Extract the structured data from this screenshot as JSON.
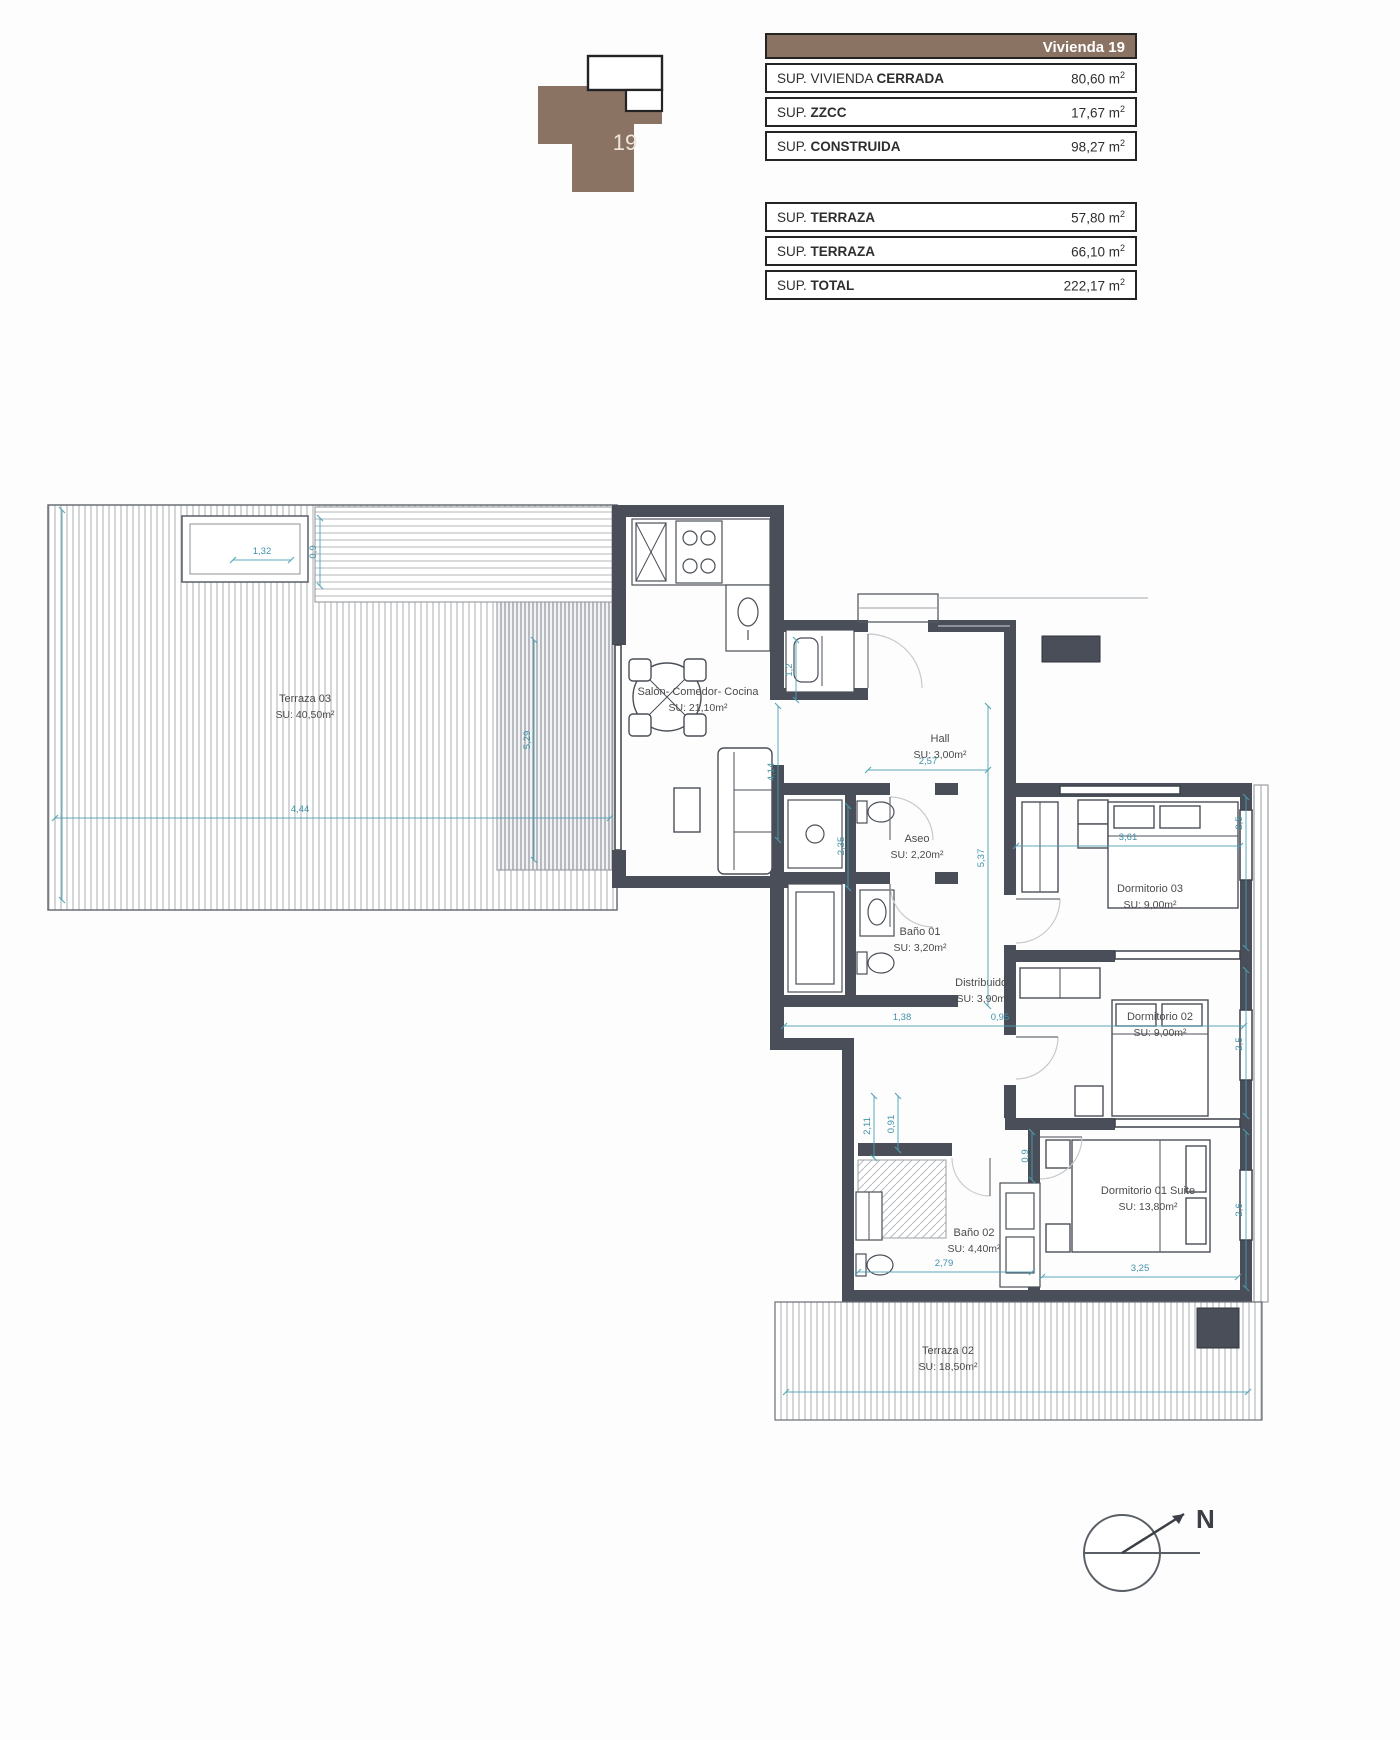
{
  "unit": {
    "number": "19"
  },
  "tables": {
    "unit_symbol": "m",
    "unit_exponent": "2",
    "main": {
      "header": "Vivienda 19",
      "rows": [
        {
          "label_plain": "SUP. VIVIENDA ",
          "label_bold": "CERRADA",
          "value": "80,60"
        },
        {
          "label_plain": "SUP. ",
          "label_bold": "ZZCC",
          "value": "17,67"
        },
        {
          "label_plain": "SUP. ",
          "label_bold": "CONSTRUIDA",
          "value": "98,27"
        }
      ]
    },
    "secondary": {
      "rows": [
        {
          "label_plain": "SUP. ",
          "label_bold": "TERRAZA",
          "value": "57,80"
        },
        {
          "label_plain": "SUP. ",
          "label_bold": "TERRAZA",
          "value": "66,10"
        },
        {
          "label_plain": "SUP. ",
          "label_bold": "TOTAL",
          "value": "222,17"
        }
      ]
    }
  },
  "rooms": [
    {
      "name": "Terraza 03",
      "area": "SU: 40,50m²"
    },
    {
      "name": "Salón- Comedor- Cocina",
      "area": "SU: 21,10m²"
    },
    {
      "name": "Hall",
      "area": "SU: 3,00m²"
    },
    {
      "name": "Aseo",
      "area": "SU: 2,20m²"
    },
    {
      "name": "Baño 01",
      "area": "SU: 3,20m²"
    },
    {
      "name": "Distribuidor",
      "area": "SU: 3,90m²"
    },
    {
      "name": "Dormitorio 03",
      "area": "SU: 9,00m²"
    },
    {
      "name": "Dormitorio 02",
      "area": "SU: 9,00m²"
    },
    {
      "name": "Dormitorio 01 Suite",
      "area": "SU: 13,80m²"
    },
    {
      "name": "Baño 02",
      "area": "SU: 4,40m²"
    },
    {
      "name": "Terraza 02",
      "area": "SU: 18,50m²"
    }
  ],
  "dims": [
    "1,32",
    "0,9",
    "4,44",
    "5,29",
    "1,2",
    "4,14",
    "2,57",
    "5,37",
    "2,35",
    "3,61",
    "2,5",
    "1,38",
    "0,95",
    "2,5",
    "2,11",
    "0,91",
    "0,9",
    "2,79",
    "3,25",
    "2,6"
  ],
  "compass": {
    "north_label": "N"
  },
  "colors": {
    "wall": "#4A4E58",
    "dimension": "#4BA1B5",
    "brand_brown": "#8B7364"
  }
}
